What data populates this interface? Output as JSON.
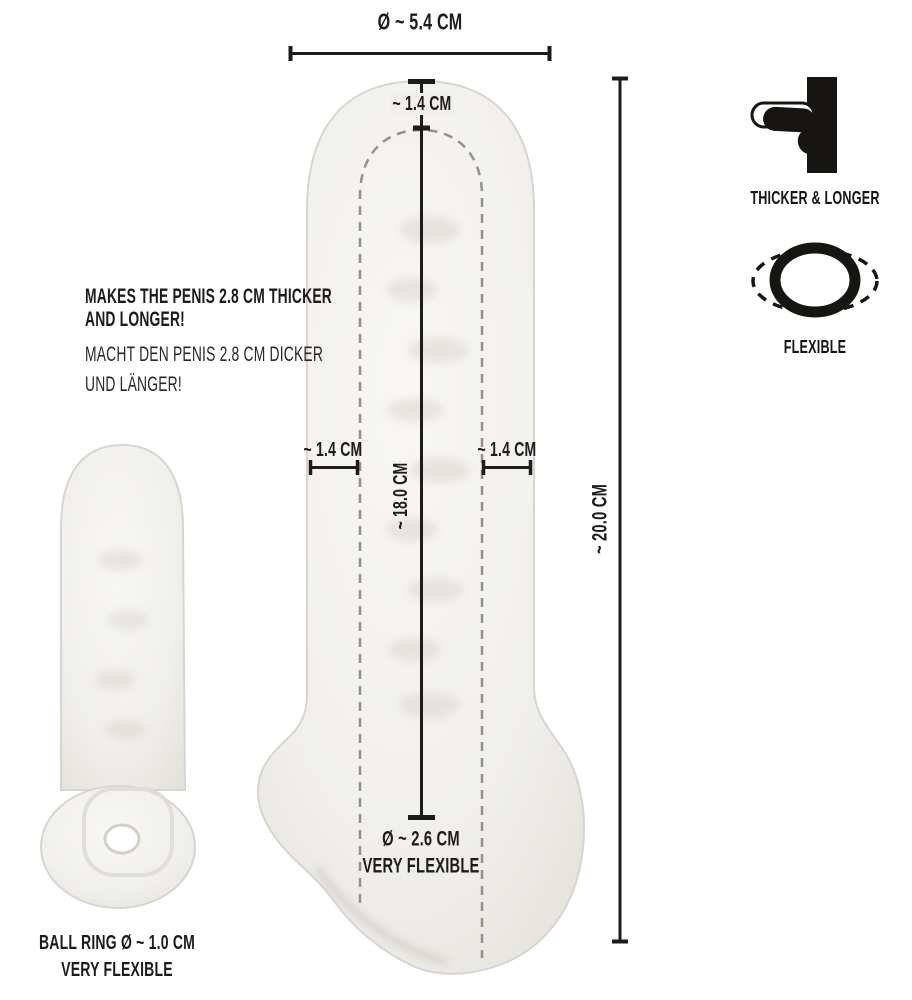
{
  "diagram_title": "penis-sleeve-dimension-diagram",
  "labels": {
    "top_diameter": "Ø ~ 5.4 CM",
    "tip_thickness": "~ 1.4 CM",
    "left_wall": "~ 1.4 CM",
    "right_wall": "~ 1.4 CM",
    "inner_length": "~ 18.0 CM",
    "outer_length": "~ 20.0 CM",
    "opening_diameter": "Ø ~ 2.6 CM",
    "opening_flex": "VERY FLEXIBLE",
    "ball_ring": "BALL RING Ø ~ 1.0 CM",
    "ball_ring_flex": "VERY FLEXIBLE"
  },
  "description": {
    "en": [
      "MAKES THE PENIS 2.8 CM THICKER",
      "AND LONGER!"
    ],
    "de": [
      "MACHT DEN PENIS 2.8 CM DICKER",
      "UND LÄNGER!"
    ]
  },
  "features": [
    {
      "icon": "thicker-longer-icon",
      "label": "THICKER & LONGER"
    },
    {
      "icon": "flexible-ring-icon",
      "label": "FLEXIBLE"
    }
  ],
  "colors": {
    "ink": "#1d1c1a",
    "dashed_line": "#94918c",
    "sleeve_fill": "#f0efeb",
    "sleeve_edge": "#d8d5cf",
    "background": "#ffffff"
  }
}
